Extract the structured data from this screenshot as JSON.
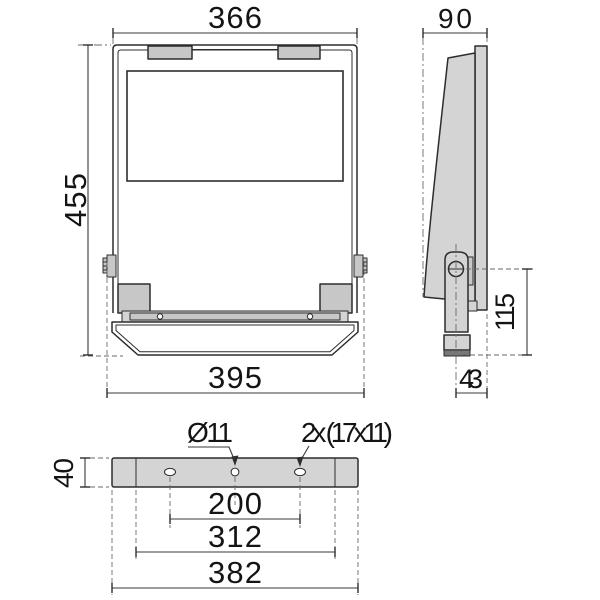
{
  "drawing_type": "luminaire dimensional technical drawing",
  "front_view": {
    "width_top": "366",
    "height": "455",
    "width_bottom": "395"
  },
  "side_view": {
    "depth": "90",
    "pivot_to_base": "115",
    "base_depth": "43"
  },
  "bottom_view": {
    "center_hole": "Ø11",
    "slot_holes": "2x (17x11)",
    "bracket_height": "40",
    "hole_spacing": "200",
    "inner_span": "312",
    "overall_span": "382"
  },
  "colors": {
    "line": "#2d2d2d",
    "dimension_line": "#3a3a3a",
    "extension_line": "#6a6a6a",
    "fill_light": "#d4d4d4",
    "fill_mid": "#c7c7c7",
    "fill_dark": "#787878",
    "background": "#ffffff"
  }
}
